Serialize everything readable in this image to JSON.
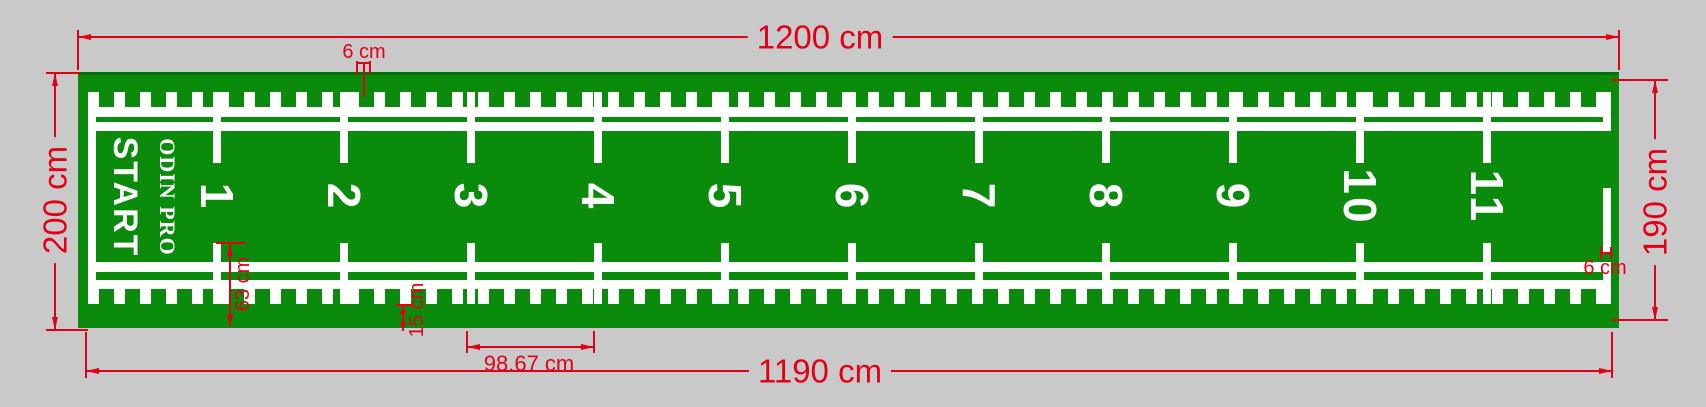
{
  "drawing": {
    "background_color": "#c9c9c9",
    "mat_color": "#0b8b0b",
    "marking_color": "#ffffff",
    "dimension_color": "#e30016"
  },
  "mat": {
    "start_label": "START",
    "brand": "ODIN PRO",
    "lane_numbers": [
      "1",
      "2",
      "3",
      "4",
      "5",
      "6",
      "7",
      "8",
      "9",
      "10",
      "11"
    ]
  },
  "dimensions": {
    "top_width": "1200 cm",
    "bottom_width": "1190 cm",
    "left_height": "200 cm",
    "right_height": "190 cm",
    "tick_width_top": "6 cm",
    "finish_line_width": "6 cm",
    "lane_spacing": "98.67 cm",
    "bottom_zone_height": "63 cm",
    "edge_margin": "15 cm"
  }
}
